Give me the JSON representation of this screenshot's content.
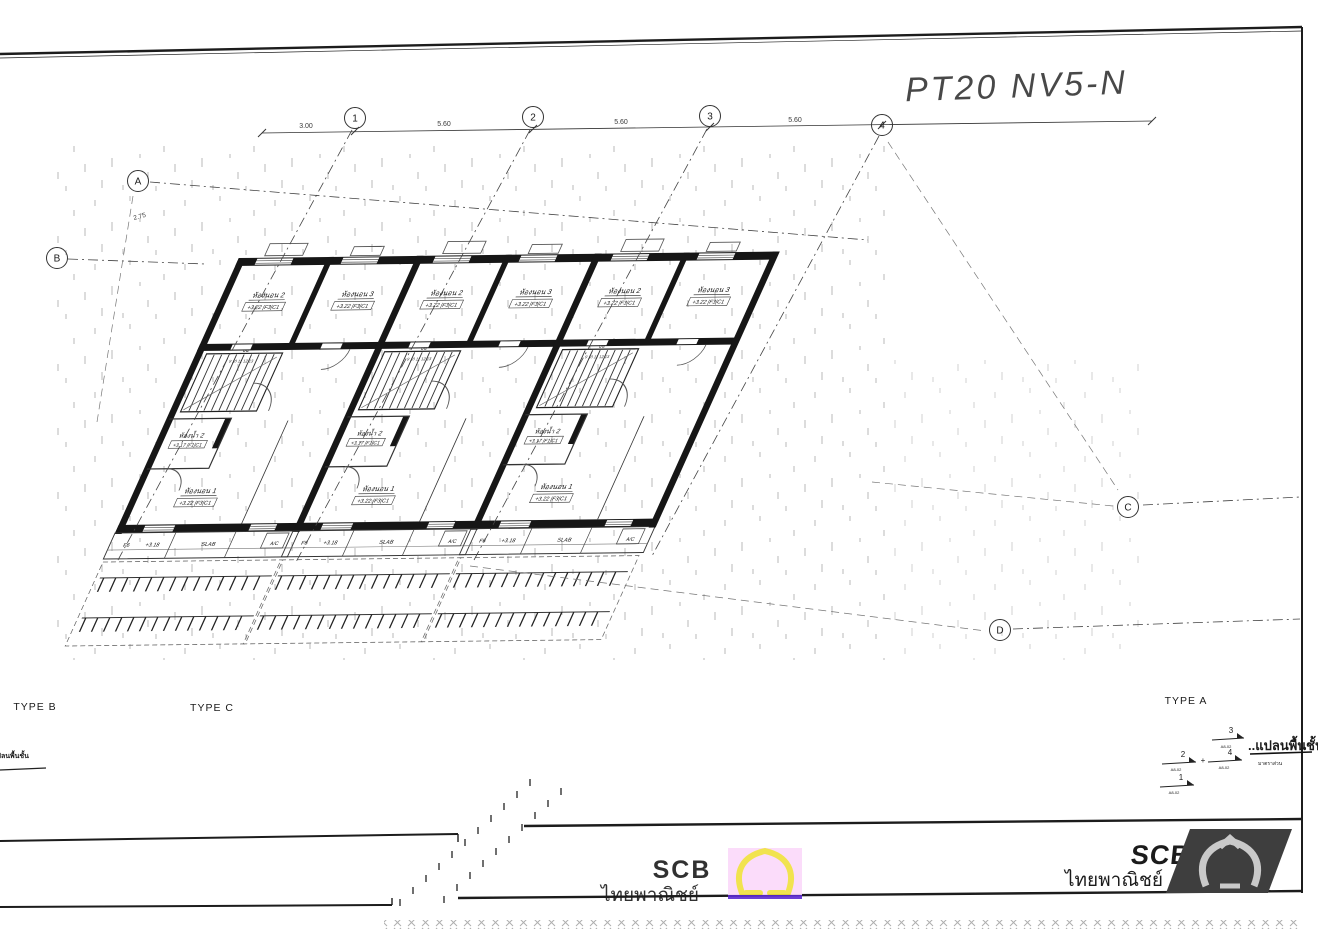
{
  "title": {
    "handwritten": "PT20 NV5-N"
  },
  "grid": {
    "cols": [
      "1",
      "2",
      "3",
      "4"
    ],
    "rows": [
      "A",
      "B",
      "C",
      "D"
    ],
    "dims": {
      "left": "3.00",
      "bay": "5.60",
      "side": "2.75"
    }
  },
  "rooms": {
    "bedroom2": {
      "name": "ห้องนอน 2",
      "tags": "+3.22 |F3|C1"
    },
    "bedroom3": {
      "name": "ห้องนอน 3",
      "tags": "+3.22 |F3|C1"
    },
    "bedroom1": {
      "name": "ห้องนอน 1",
      "tags": "+3.22 |F3|C1"
    },
    "bath2": {
      "name": "ห้องน้ำ 2",
      "tags": "+3.17 |F1|C1"
    },
    "stair_up": "บน",
    "stair_treads": "9 10 11 12 13"
  },
  "front": {
    "f6": "F6",
    "level": "+3.18",
    "slab": "SLAB",
    "ac": "A/C"
  },
  "types": {
    "b": "TYPE B",
    "c": "TYPE C",
    "a": "TYPE A"
  },
  "keyplan": {
    "marks": [
      "1",
      "2",
      "3",
      "4"
    ],
    "mark_sub": "A8-02",
    "plus": "+",
    "caption": "..แปลนพื้นชั้น",
    "scale_note": "มาตราส่วน"
  },
  "stamp": {
    "line1": "แปลนพื้นชั้น"
  },
  "watermark": {
    "scb": "SCB",
    "thai": "ไทยพาณิชย์"
  },
  "logo": {
    "scb": "SCB",
    "thai": "ไทยพาณิชย์"
  }
}
